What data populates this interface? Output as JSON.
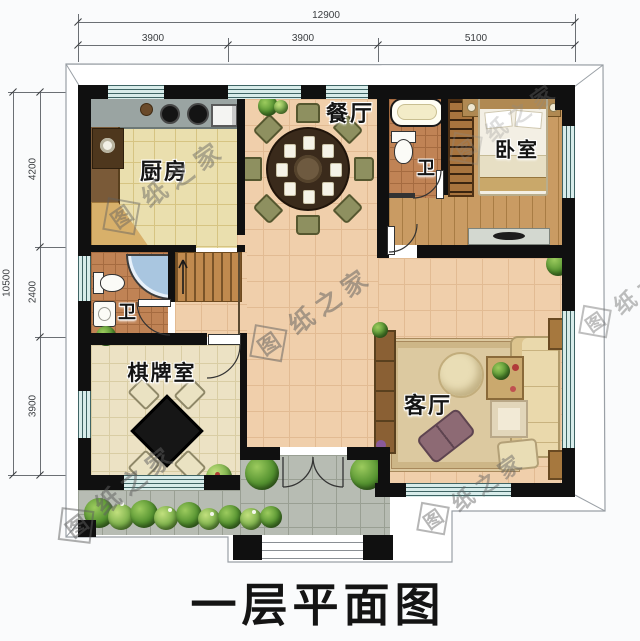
{
  "page": {
    "title": "一层平面图"
  },
  "watermark": {
    "first": "图",
    "rest": "纸之家",
    "full": "图纸之家"
  },
  "dimensions": {
    "top": {
      "overall": "12900",
      "segments": [
        "3900",
        "3900",
        "5100"
      ]
    },
    "left": {
      "overall": "10500",
      "segments": [
        "4200",
        "2400",
        "3900"
      ]
    }
  },
  "rooms": {
    "kitchen": {
      "label": "厨房"
    },
    "dining": {
      "label": "餐厅"
    },
    "bath_upper": {
      "label": "卫"
    },
    "bedroom": {
      "label": "卧室"
    },
    "bath_lower": {
      "label": "卫"
    },
    "game_room": {
      "label": "棋牌室"
    },
    "living_room": {
      "label": "客厅"
    }
  },
  "colors": {
    "wall": "#101010",
    "floor_main": "#f0cfab",
    "floor_kitchen": "#eadfae",
    "floor_wood": "#c99b63",
    "floor_tile": "#c08355",
    "floor_game": "#ece2c4",
    "porch": "#b7bcb3",
    "window_glass": "#d8ecea",
    "window_frame": "#3f6464",
    "greenery": "#53912f"
  }
}
